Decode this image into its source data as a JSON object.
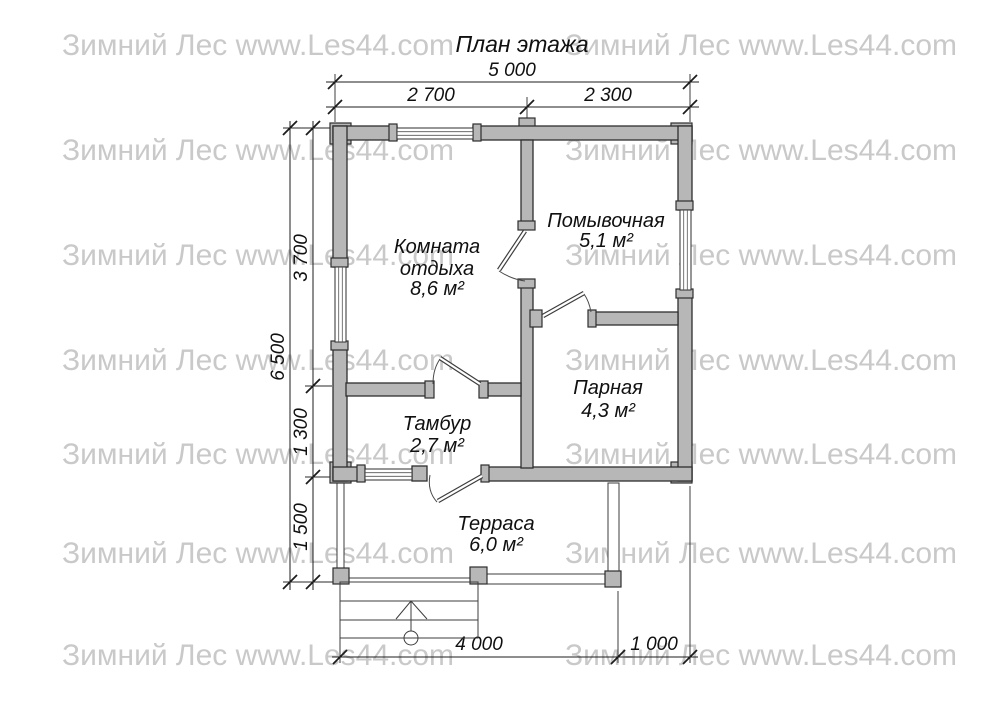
{
  "title": "План этажа",
  "watermark": {
    "text": "Зимний Лес www.Les44.com"
  },
  "rooms": {
    "rest": {
      "line1": "Комната",
      "line2": "отдыха",
      "area": "8,6 м²"
    },
    "wash": {
      "name": "Помывочная",
      "area": "5,1 м²"
    },
    "steam": {
      "name": "Парная",
      "area": "4,3 м²"
    },
    "vestibule": {
      "name": "Тамбур",
      "area": "2,7 м²"
    },
    "terrace": {
      "name": "Терраса",
      "area": "6,0 м²"
    }
  },
  "dimensions": {
    "top_total": "5 000",
    "top_left": "2 700",
    "top_right": "2 300",
    "left_total": "6 500",
    "left_upper": "3 700",
    "left_middle": "1 300",
    "left_lower": "1 500",
    "bottom_terrace": "4 000",
    "bottom_right": "1 000"
  },
  "colors": {
    "wallFill": "#b7b7b7",
    "lineColor": "#2e2e2e",
    "watermarkColor": "#c9c9c9"
  }
}
